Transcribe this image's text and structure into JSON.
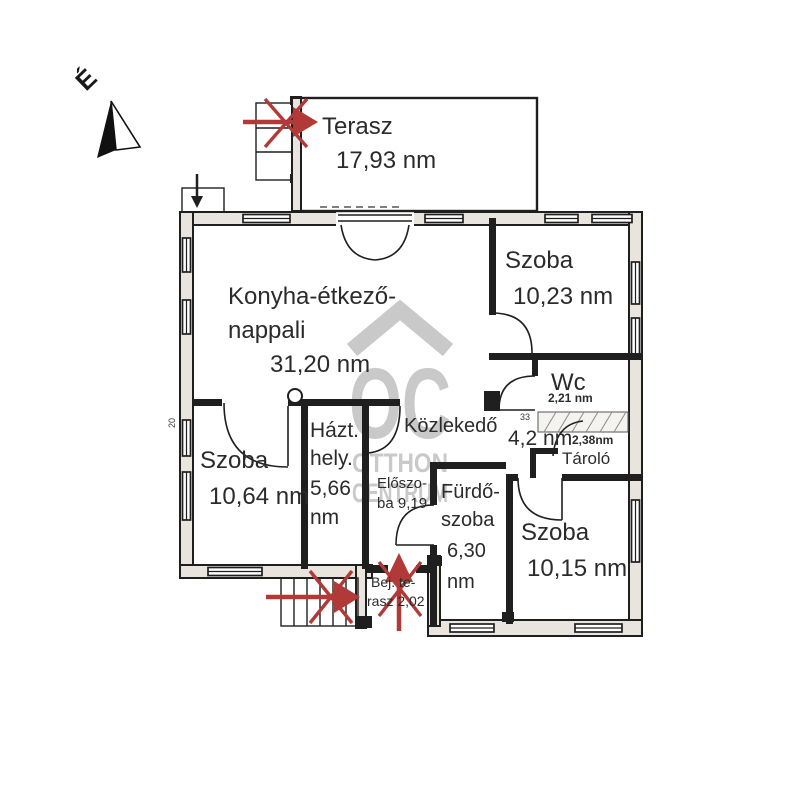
{
  "compass": {
    "north_label": "É"
  },
  "watermark": {
    "logo": "OC",
    "line1": "OTTHON",
    "line2": "CENTRUM"
  },
  "colors": {
    "arrow_red": "#b13a38",
    "watermark_gray": "#c9c9c9",
    "wall_black": "#1f1f1f",
    "background": "#ffffff"
  },
  "rooms": {
    "terasz": {
      "name": "Terasz",
      "area": "17,93 nm"
    },
    "konyha": {
      "name_line1": "Konyha-étkező-",
      "name_line2": "nappali",
      "area": "31,20 nm"
    },
    "szoba_eszaki": {
      "name": "Szoba",
      "area": "10,23 nm"
    },
    "wc": {
      "name": "Wc",
      "area": "2,21 nm"
    },
    "kozlekedo": {
      "name": "Közlekedő",
      "area": "4,2 nm"
    },
    "tarolo": {
      "name": "Tároló",
      "area": "2,38nm"
    },
    "szoba_nyugati": {
      "name": "Szoba",
      "area": "10,64 nm"
    },
    "haztartasi": {
      "line1": "Házt.",
      "line2": "hely.",
      "line3": "5,66",
      "line4": "nm"
    },
    "eloszoba": {
      "line1": "Előszo-",
      "line2": "ba 9,19"
    },
    "furdoszoba": {
      "line1": "Fürdő-",
      "line2": "szoba",
      "line3": "6,30",
      "line4": "nm"
    },
    "szoba_deli": {
      "name": "Szoba",
      "area": "10,15 nm"
    },
    "bejarati_terasz": {
      "line1": "Bej. te-",
      "line2": "rasz 2,02"
    }
  },
  "dimensions": {
    "left_wall": "20",
    "wc_wall": "33"
  }
}
